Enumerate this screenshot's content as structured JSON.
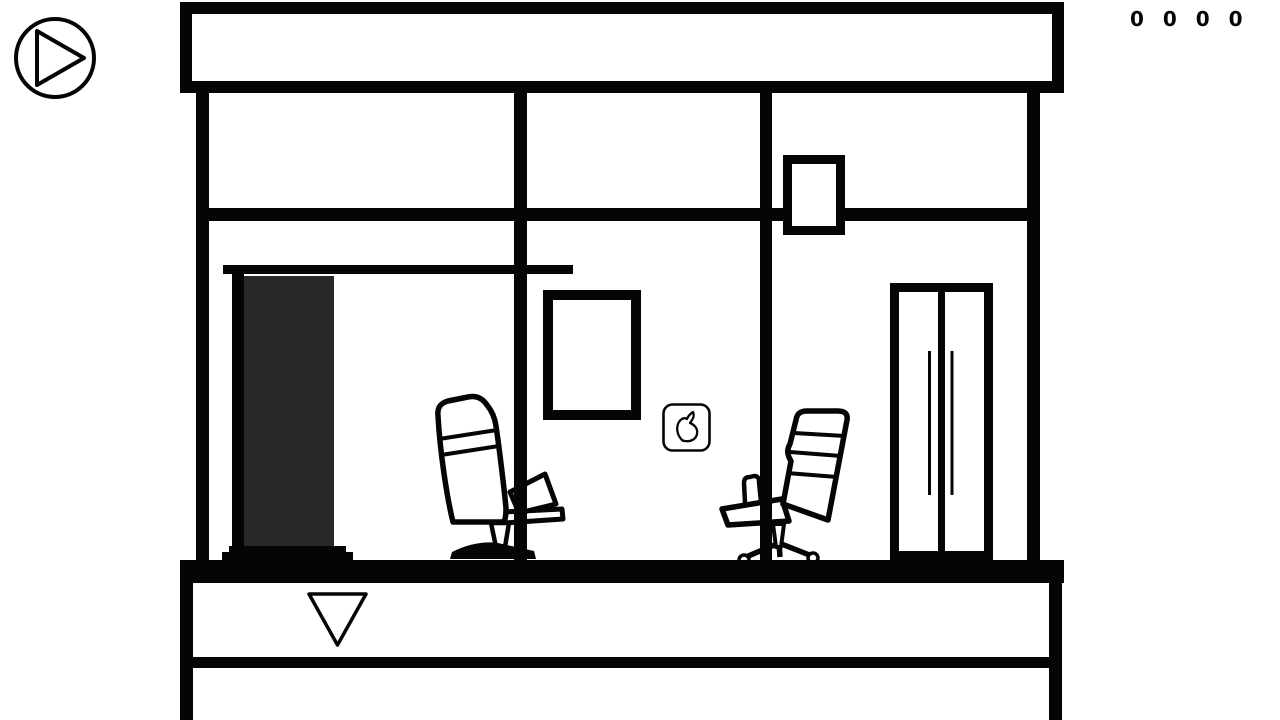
{
  "hud": {
    "play_button": {
      "icon": "play-icon"
    },
    "counter": {
      "value": "0 0 0 0",
      "digits": [
        "0",
        "0",
        "0",
        "0"
      ]
    },
    "nav": {
      "down_icon": "down-arrow-icon"
    }
  },
  "scene": {
    "style": "black-and-white line-art room",
    "objects": [
      "roof-band",
      "ceiling-beam",
      "left-wall",
      "right-wall",
      "support-column-left",
      "support-column-right",
      "wall-window",
      "doorway-lintel",
      "doorway-jamb",
      "dark-door-panel",
      "doorway-threshold",
      "picture-frame",
      "rabbit-icon-button",
      "office-chair-left",
      "office-chair-right",
      "double-door",
      "door-handle-left",
      "door-handle-right",
      "floor",
      "basement-band",
      "down-arrow-button"
    ]
  },
  "colors": {
    "ink": "#050505",
    "background": "#ffffff",
    "door_panel": "#282828"
  }
}
